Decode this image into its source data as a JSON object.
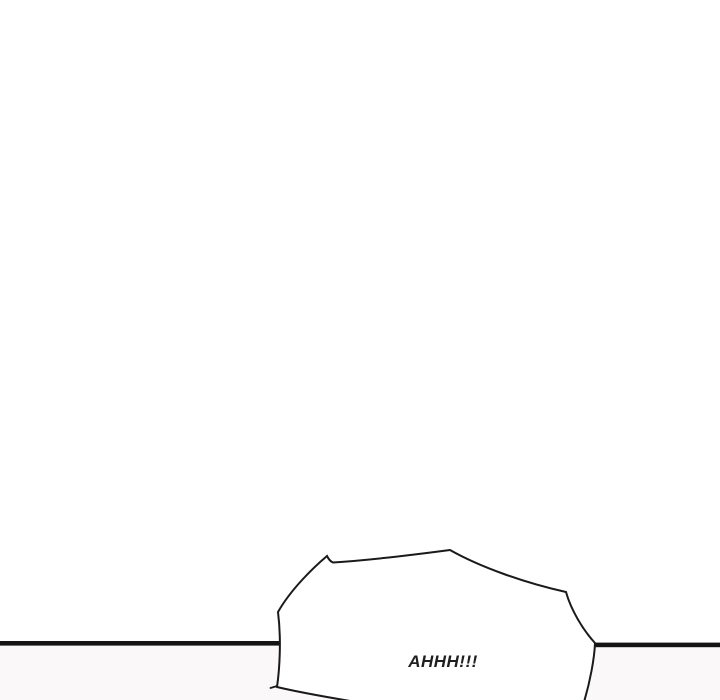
{
  "canvas": {
    "background": "#ffffff",
    "width_px": 720,
    "height_px": 700
  },
  "panel": {
    "divider_color": "#141414",
    "below_divider_background": "#faf8f8"
  },
  "speech_bubble": {
    "type": "shout-burst",
    "text": "AHHH!!!",
    "fill": "#ffffff",
    "outline_color": "#1a1a1a",
    "text_color": "#1f1f1f"
  }
}
